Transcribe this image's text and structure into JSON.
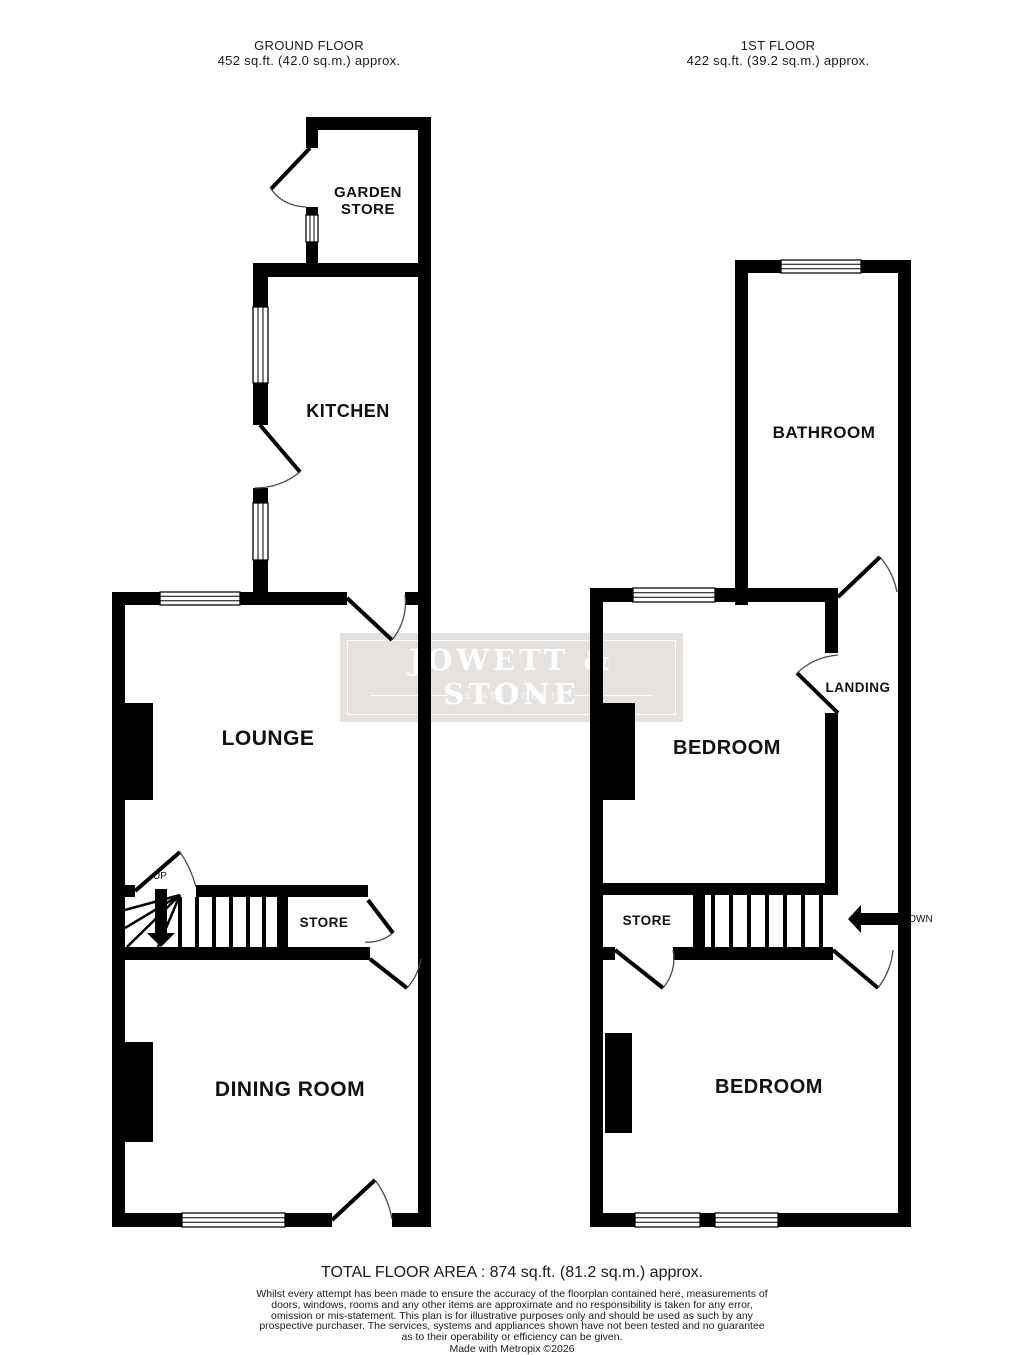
{
  "colors": {
    "wall": "#000000",
    "window_fill": "#ffffff",
    "door_arc": "#4a4a4a",
    "watermark_bg": "#e5e2df",
    "watermark_text": "#ffffff",
    "text": "#111111"
  },
  "floors": {
    "ground": {
      "title": "GROUND FLOOR",
      "subtitle": "452 sq.ft. (42.0 sq.m.) approx."
    },
    "first": {
      "title": "1ST FLOOR",
      "subtitle": "422 sq.ft. (39.2 sq.m.) approx."
    }
  },
  "rooms": {
    "garden_store_line1": "GARDEN",
    "garden_store_line2": "STORE",
    "kitchen": "KITCHEN",
    "lounge": "LOUNGE",
    "store_ground": "STORE",
    "dining": "DINING ROOM",
    "bathroom": "BATHROOM",
    "landing": "LANDING",
    "bedroom_front": "BEDROOM",
    "store_first": "STORE",
    "bedroom_back": "BEDROOM"
  },
  "stairs": {
    "up_label": "UP",
    "down_label": "DOWN"
  },
  "watermark": {
    "title": "JOWETT & STONE",
    "subtitle": "ESTATE AGENTS"
  },
  "footer": {
    "total_area": "TOTAL FLOOR AREA : 874 sq.ft. (81.2 sq.m.) approx.",
    "disclaimer": "Whilst every attempt has been made to ensure the accuracy of the floorplan contained here, measurements of doors, windows, rooms and any other items are approximate and no responsibility is taken for any error, omission or mis-statement. This plan is for illustrative purposes only and should be used as such by any prospective purchaser. The services, systems and appliances shown have not been tested and no guarantee as to their operability or efficiency can be given.",
    "credit": "Made with Metropix ©2026"
  }
}
